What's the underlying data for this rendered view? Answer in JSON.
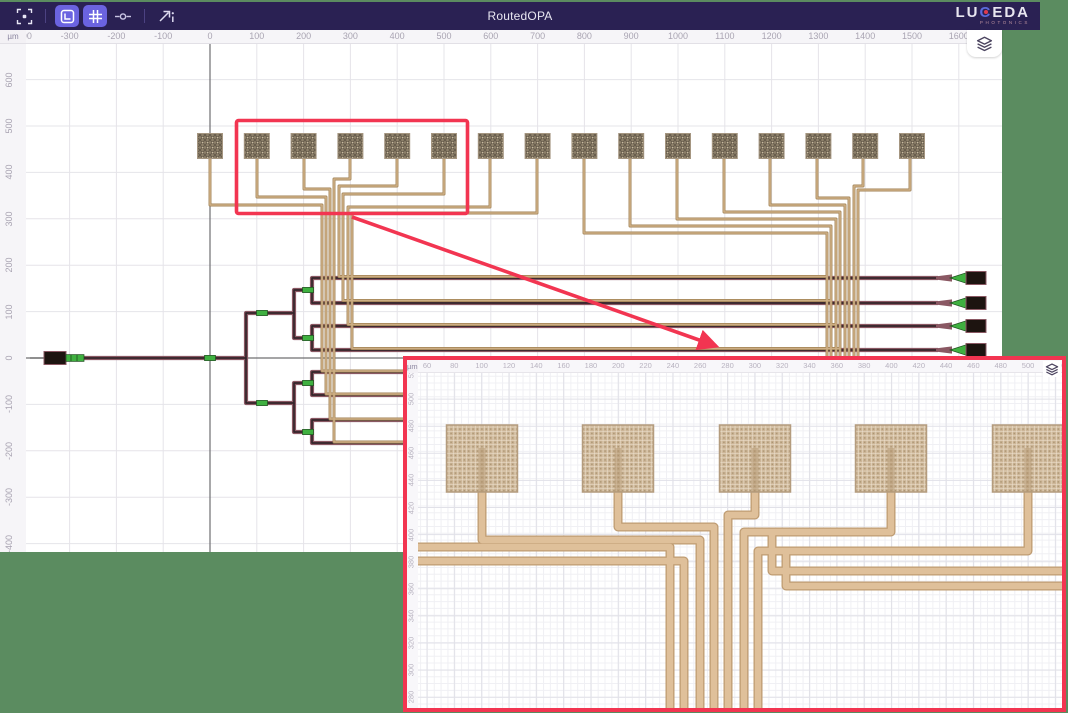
{
  "app": {
    "title": "RoutedOPA"
  },
  "brand": {
    "name_pre": "LU",
    "name_c": "C",
    "name_post": "EDA",
    "subtitle": "PHOTONICS"
  },
  "toolbar": {
    "buttons": [
      {
        "name": "fit-view",
        "active": false
      },
      {
        "name": "toggle-rulers",
        "active": true
      },
      {
        "name": "toggle-grid",
        "active": true
      },
      {
        "name": "toggle-ports",
        "active": false
      },
      {
        "name": "export-view",
        "active": false
      }
    ]
  },
  "rulers": {
    "unit": "µm",
    "top_ticks": [
      -400,
      -300,
      -200,
      -100,
      0,
      100,
      200,
      300,
      400,
      500,
      600,
      700,
      800,
      900,
      1000,
      1100,
      1200,
      1300,
      1400,
      1500,
      1600
    ],
    "left_ticks": [
      600,
      500,
      400,
      300,
      200,
      100,
      0,
      -100,
      -200,
      -300,
      -400
    ]
  },
  "inset": {
    "unit": "µm",
    "top_ticks": [
      60,
      80,
      100,
      120,
      140,
      160,
      180,
      200,
      220,
      240,
      260,
      280,
      300,
      320,
      340,
      360,
      380,
      400,
      420,
      440,
      460,
      480,
      500,
      520
    ],
    "left_ticks": [
      520,
      500,
      480,
      460,
      440,
      420,
      400,
      380,
      360,
      340,
      320,
      300,
      280
    ]
  },
  "colors": {
    "desktop_green": "#5b8c60",
    "toolbar_bg": "#2a2153",
    "toolbar_active": "#6b63e0",
    "accent_red": "#f23551",
    "grid": "#e5e4e9",
    "axis": "#6f6f72",
    "pad_base": "#8d8069",
    "pad_hatch": "#665b4c",
    "trace_edge": "#a08254",
    "trace_fill": "#cdae84",
    "wg_edge": "#8a5863",
    "wg_core": "#33242a",
    "component_green": "#3fb040",
    "gc_black": "#1d1410",
    "inset_trace_edge": "#bf9c72",
    "inset_trace_fill": "#dfc09a",
    "inset_pad_base": "#cdb698",
    "inset_pad_line": "#eee3d0"
  },
  "layout_data": {
    "main": {
      "px_per_um_x": 0.468,
      "px_per_um_y": 0.464,
      "origin_x": 210,
      "origin_y": 358,
      "grid_step_um": 100,
      "pads": {
        "count": 16,
        "first_cx": 210,
        "pitch": 46.8,
        "top": 133.5,
        "size": 25
      },
      "tree": [
        [
          [
            66,
            358
          ],
          [
            246,
            358
          ],
          [
            246,
            313
          ],
          [
            294,
            313
          ],
          [
            294,
            290
          ],
          [
            312,
            290
          ],
          [
            312,
            278
          ],
          [
            938,
            278
          ]
        ],
        [
          [
            312,
            290
          ],
          [
            312,
            303
          ],
          [
            938,
            303
          ]
        ],
        [
          [
            294,
            313
          ],
          [
            294,
            338
          ],
          [
            312,
            338
          ],
          [
            312,
            326
          ],
          [
            938,
            326
          ]
        ],
        [
          [
            312,
            338
          ],
          [
            312,
            350
          ],
          [
            938,
            350
          ]
        ],
        [
          [
            246,
            358
          ],
          [
            246,
            403
          ],
          [
            294,
            403
          ],
          [
            294,
            383
          ],
          [
            312,
            383
          ],
          [
            312,
            372
          ],
          [
            405,
            372
          ]
        ],
        [
          [
            312,
            383
          ],
          [
            312,
            395
          ],
          [
            405,
            395
          ]
        ],
        [
          [
            294,
            403
          ],
          [
            294,
            432
          ],
          [
            312,
            432
          ],
          [
            312,
            420
          ],
          [
            405,
            420
          ]
        ],
        [
          [
            312,
            432
          ],
          [
            312,
            443
          ],
          [
            405,
            443
          ]
        ]
      ],
      "green_segments": [
        [
          210,
          358
        ],
        [
          262,
          313
        ],
        [
          262,
          403
        ],
        [
          308,
          290
        ],
        [
          308,
          338
        ],
        [
          308,
          383
        ],
        [
          308,
          432
        ]
      ],
      "output_couplers_y": [
        278,
        303,
        326,
        350
      ],
      "traces": [
        [
          [
            210,
            156
          ],
          [
            210,
            205
          ],
          [
            322,
            205
          ],
          [
            322,
            371
          ],
          [
            405,
            371
          ]
        ],
        [
          [
            257,
            156
          ],
          [
            257,
            197
          ],
          [
            326,
            197
          ],
          [
            326,
            394
          ],
          [
            405,
            394
          ]
        ],
        [
          [
            304,
            156
          ],
          [
            304,
            189
          ],
          [
            330,
            189
          ],
          [
            330,
            419
          ],
          [
            405,
            419
          ]
        ],
        [
          [
            350,
            156
          ],
          [
            350,
            179
          ],
          [
            334,
            179
          ],
          [
            334,
            442
          ],
          [
            405,
            442
          ]
        ],
        [
          [
            397,
            156
          ],
          [
            397,
            186
          ],
          [
            339,
            186
          ],
          [
            339,
            276.5
          ],
          [
            827,
            276.5
          ]
        ],
        [
          [
            444,
            156
          ],
          [
            444,
            194
          ],
          [
            343,
            194
          ],
          [
            343,
            300.5
          ],
          [
            831,
            300.5
          ]
        ],
        [
          [
            490,
            156
          ],
          [
            490,
            207
          ],
          [
            348,
            207
          ],
          [
            348,
            324.5
          ],
          [
            836,
            324.5
          ]
        ],
        [
          [
            537,
            156
          ],
          [
            537,
            213
          ],
          [
            352,
            213
          ],
          [
            352,
            348.5
          ],
          [
            840,
            348.5
          ]
        ],
        [
          [
            584,
            156
          ],
          [
            584,
            233
          ],
          [
            827,
            233
          ],
          [
            827,
            358
          ]
        ],
        [
          [
            630,
            156
          ],
          [
            630,
            226
          ],
          [
            831,
            226
          ],
          [
            831,
            358
          ]
        ],
        [
          [
            677,
            156
          ],
          [
            677,
            219
          ],
          [
            836,
            219
          ],
          [
            836,
            358
          ]
        ],
        [
          [
            724,
            156
          ],
          [
            724,
            212
          ],
          [
            840,
            212
          ],
          [
            840,
            358
          ]
        ],
        [
          [
            770,
            156
          ],
          [
            770,
            205
          ],
          [
            845,
            205
          ],
          [
            845,
            358
          ]
        ],
        [
          [
            817,
            156
          ],
          [
            817,
            198
          ],
          [
            849,
            198
          ],
          [
            849,
            358
          ]
        ],
        [
          [
            863,
            156
          ],
          [
            863,
            186
          ],
          [
            854,
            186
          ],
          [
            854,
            358
          ]
        ],
        [
          [
            910,
            156
          ],
          [
            910,
            190
          ],
          [
            858,
            190
          ],
          [
            858,
            358
          ]
        ]
      ],
      "highlight_rect": {
        "x": 236.5,
        "y": 120.5,
        "w": 231,
        "h": 93
      },
      "arrow": {
        "x1": 352,
        "y1": 217,
        "x2": 716,
        "y2": 346
      }
    },
    "inset_view": {
      "px_per_um": 1.366,
      "x_of_60": 427,
      "y_of_520": 372,
      "grid_minor": 6.83,
      "grid_major": 27.32,
      "pads": {
        "centers": [
          482,
          618,
          755,
          891,
          1028
        ],
        "w": 71,
        "top": 425,
        "h": 67
      },
      "traces": [
        [
          [
            418,
            547
          ],
          [
            670,
            547
          ],
          [
            670,
            708
          ]
        ],
        [
          [
            418,
            561
          ],
          [
            684,
            561
          ],
          [
            684,
            708
          ]
        ],
        [
          [
            482,
            490
          ],
          [
            482,
            540
          ],
          [
            700,
            540
          ],
          [
            700,
            708
          ]
        ],
        [
          [
            618,
            490
          ],
          [
            618,
            527
          ],
          [
            714,
            527
          ],
          [
            714,
            708
          ]
        ],
        [
          [
            755,
            490
          ],
          [
            755,
            515
          ],
          [
            728,
            515
          ],
          [
            728,
            708
          ]
        ],
        [
          [
            891,
            490
          ],
          [
            891,
            532
          ],
          [
            744,
            532
          ],
          [
            744,
            708
          ]
        ],
        [
          [
            1028,
            490
          ],
          [
            1028,
            551
          ],
          [
            758,
            551
          ],
          [
            758,
            708
          ]
        ],
        [
          [
            772,
            532
          ],
          [
            772,
            571
          ],
          [
            1062,
            571
          ]
        ],
        [
          [
            786,
            551
          ],
          [
            786,
            586
          ],
          [
            1062,
            586
          ]
        ]
      ]
    }
  }
}
